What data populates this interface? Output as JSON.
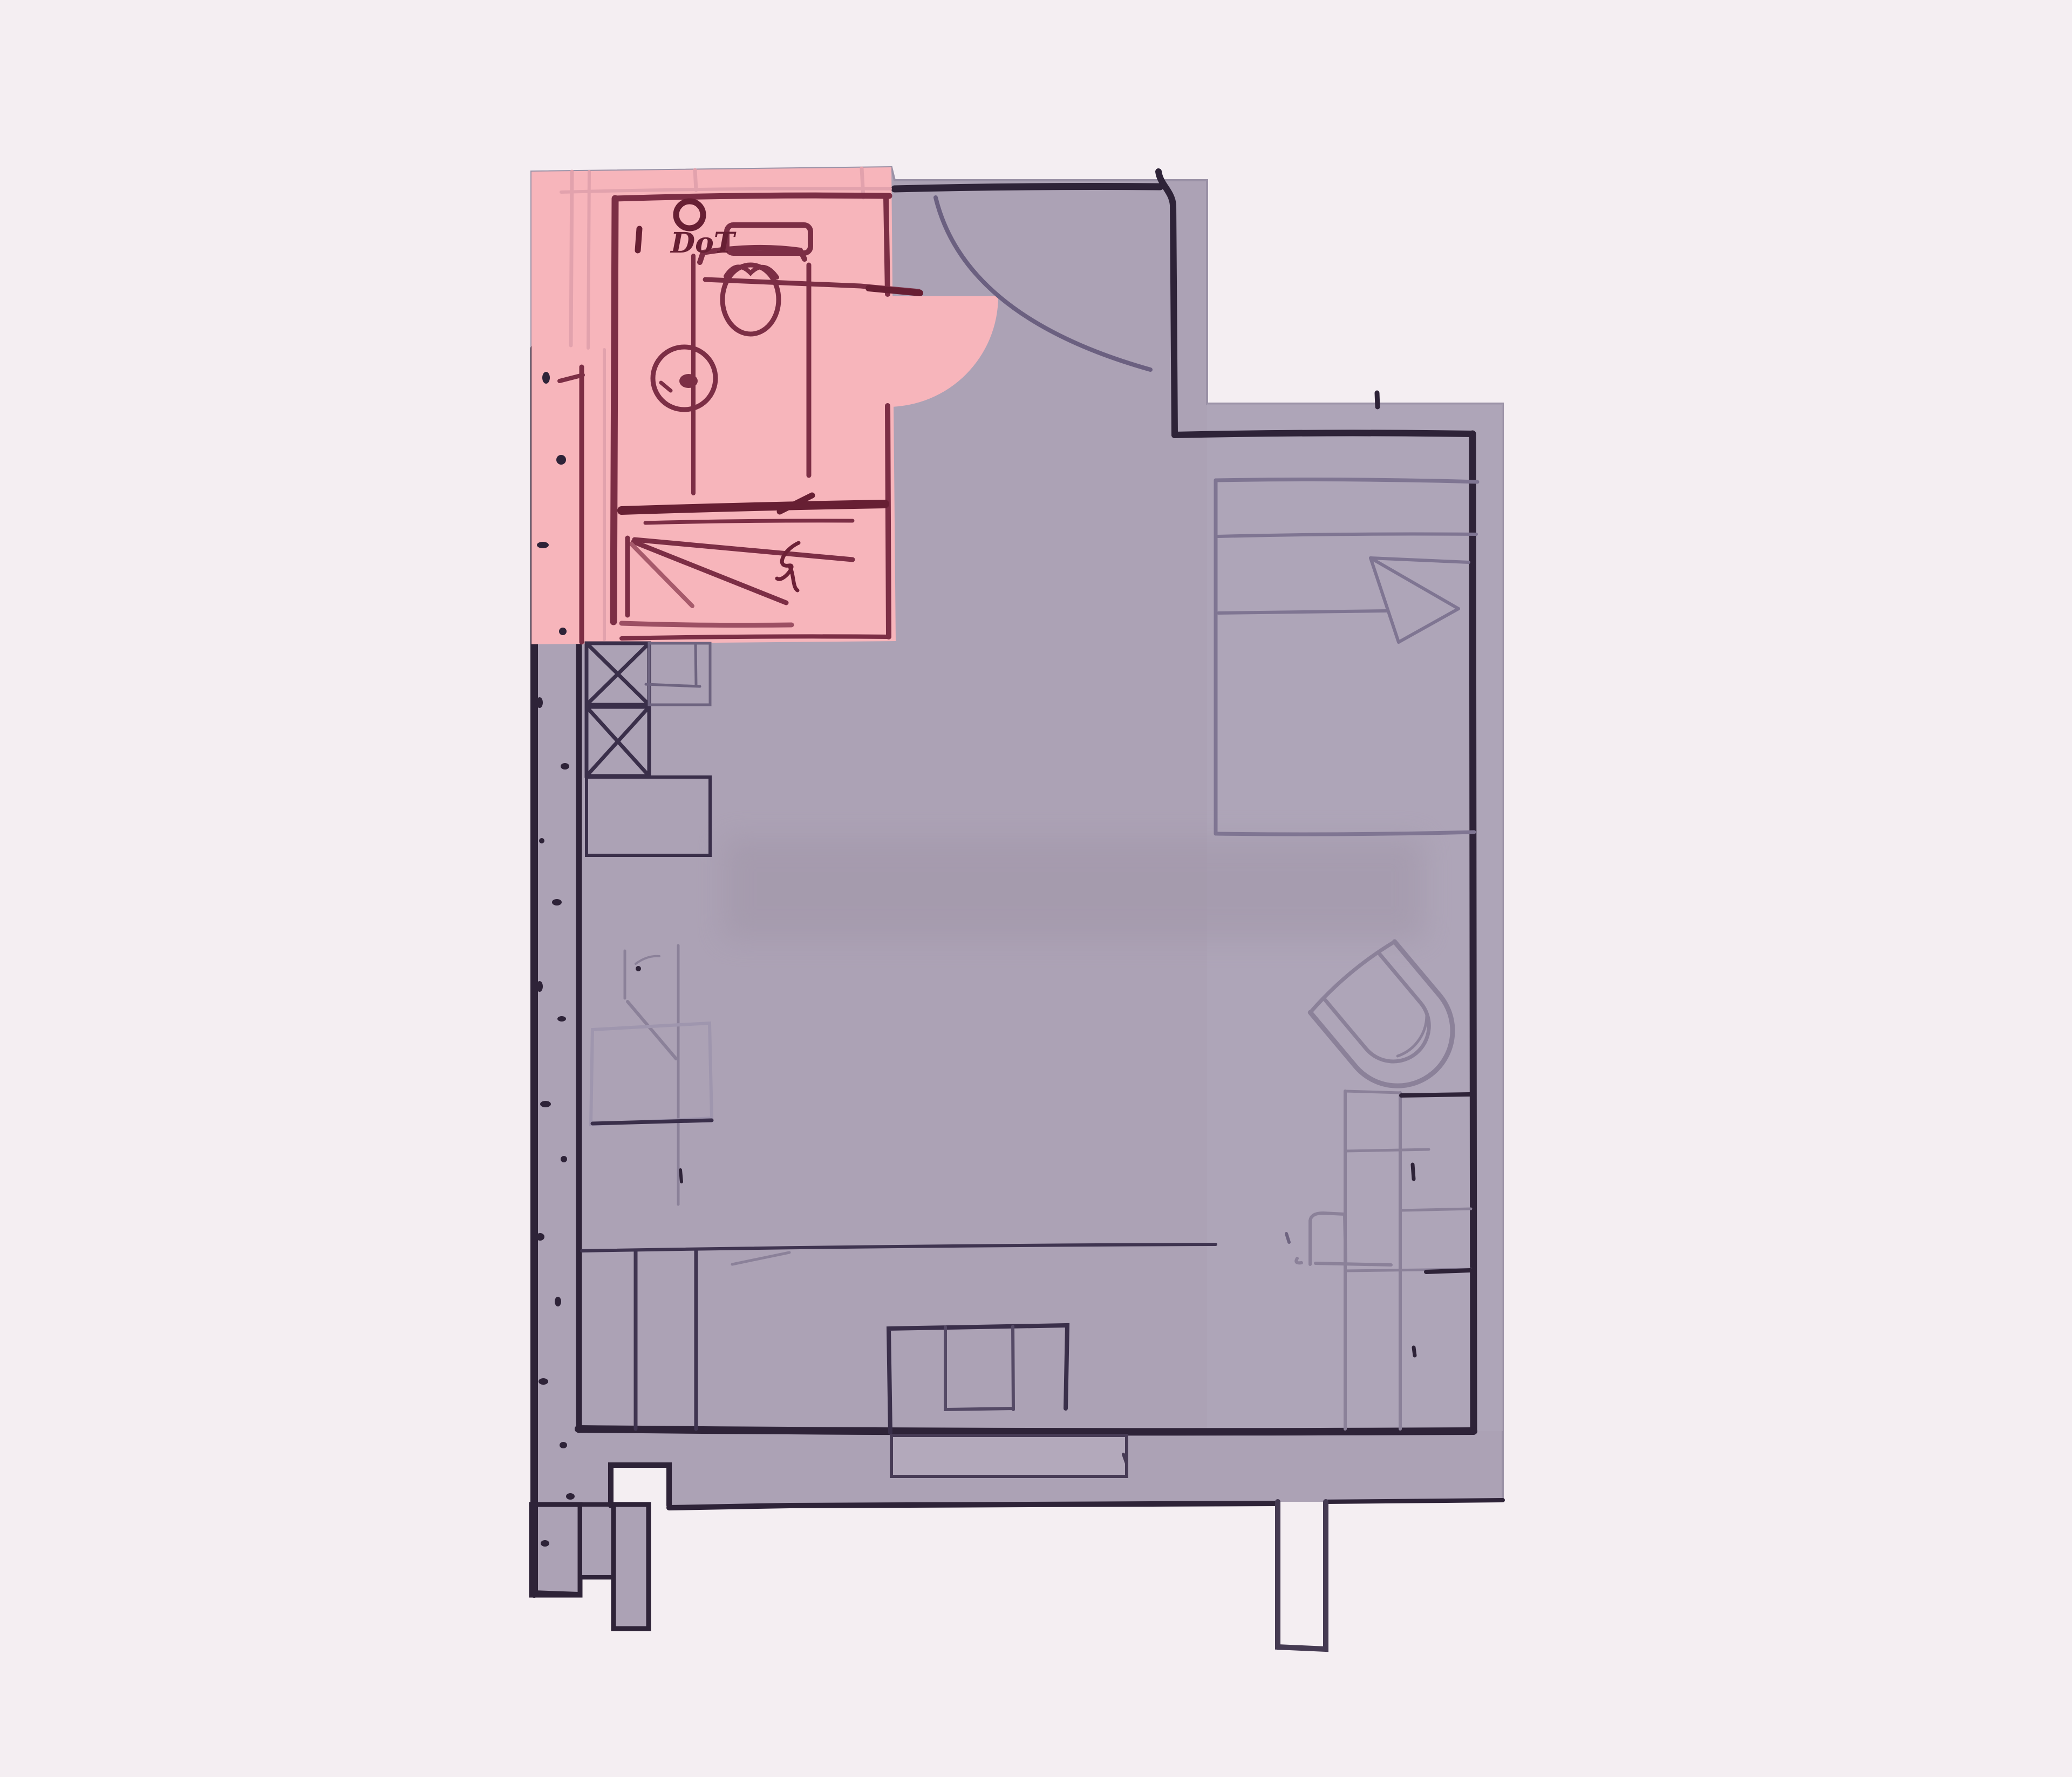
{
  "page": {
    "title": "Hand-drawn apartment floor plan sketch",
    "highlighted_room": "bathroom"
  },
  "colors": {
    "background": "#f4eef2",
    "floor": "#aca2b5",
    "floor_light": "#b1a7ba",
    "apron": "#b3a9bb",
    "bathroom_highlight": "#f7b5bb",
    "pink_seam": "#e2a2ad",
    "sketch_maroon": "#7c2e45",
    "sketch_maroon_dark": "#671f33",
    "wall_dark": "#2e2338",
    "sketch_slate": "#3a2f4a",
    "sketch_light": "#8b8199",
    "sketch_faint": "#9f96ae"
  },
  "bathroom": {
    "label": "DoT",
    "fixture_icons": [
      "toilet-icon",
      "washbasin-icon",
      "shower-rays",
      "door-swing-quarter-circle"
    ]
  },
  "main_room": {
    "furniture_icons": [
      "entry-door-arc",
      "bed-icon",
      "blanket-fold",
      "armchair-icon",
      "wardrobe-grid",
      "desk-icon",
      "sofa-icon",
      "shaft-x-boxes",
      "cabinet-column",
      "terrace-step",
      "chimney-stub",
      "dotted-left-wall"
    ]
  }
}
